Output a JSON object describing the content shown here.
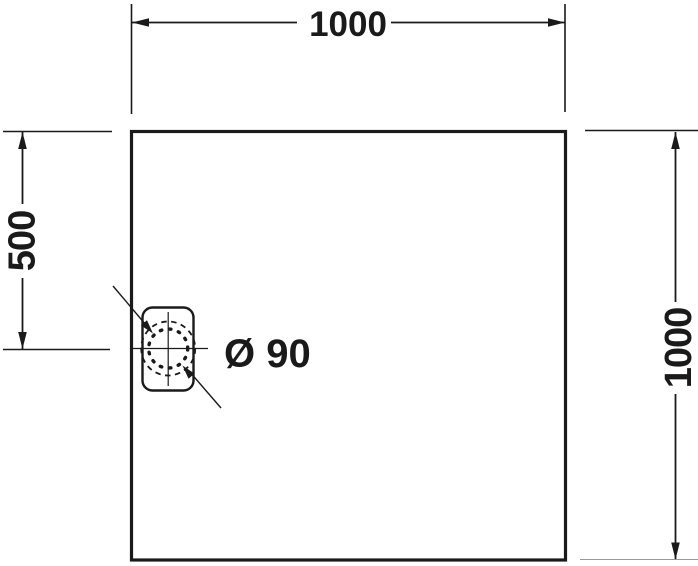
{
  "drawing": {
    "background_color": "#ffffff",
    "line_color": "#1a1a1a",
    "faint_line_color": "#999999",
    "dimensions": {
      "top_width": {
        "label": "1000"
      },
      "left_offset": {
        "label": "500"
      },
      "right_height": {
        "label": "1000"
      }
    },
    "drain": {
      "diameter_label": "Ø 90"
    }
  }
}
